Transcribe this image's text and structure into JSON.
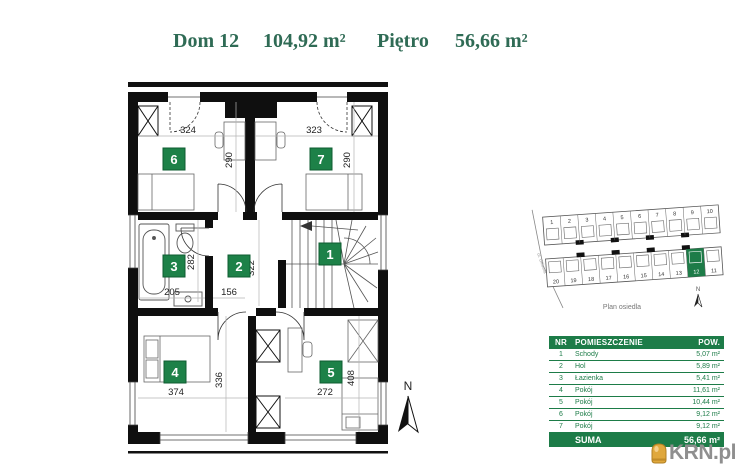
{
  "header": {
    "house_label": "Dom 12",
    "house_area": "104,92 m²",
    "floor_label": "Piętro",
    "floor_area": "56,66 m²"
  },
  "floor_plan": {
    "north_label": "N",
    "badges": {
      "b1": "1",
      "b2": "2",
      "b3": "3",
      "b4": "4",
      "b5": "5",
      "b6": "6",
      "b7": "7"
    },
    "dims": {
      "r6w": "324",
      "r6h": "290",
      "r7w": "323",
      "r7h": "290",
      "r3w": "205",
      "r3h": "282",
      "r2w": "156",
      "r2h": "322",
      "r4w": "374",
      "r4h": "336",
      "r5w": "272",
      "r5h": "408"
    }
  },
  "site_plan": {
    "caption": "Plan osiedla",
    "street_label": "ul. Główna",
    "north_label": "N",
    "top_row": [
      "1",
      "2",
      "3",
      "4",
      "5",
      "6",
      "7",
      "8",
      "9",
      "10"
    ],
    "bottom_row": [
      "20",
      "19",
      "18",
      "17",
      "16",
      "15",
      "14",
      "13",
      "12",
      "11"
    ],
    "highlighted_house": "12"
  },
  "table": {
    "headers": {
      "nr": "NR",
      "room": "POMIESZCZENIE",
      "area": "POW."
    },
    "rows": [
      {
        "nr": "1",
        "name": "Schody",
        "area": "5,07 m²"
      },
      {
        "nr": "2",
        "name": "Hol",
        "area": "5,89 m²"
      },
      {
        "nr": "3",
        "name": "Łazienka",
        "area": "5,41 m²"
      },
      {
        "nr": "4",
        "name": "Pokój",
        "area": "11,61 m²"
      },
      {
        "nr": "5",
        "name": "Pokój",
        "area": "10,44 m²"
      },
      {
        "nr": "6",
        "name": "Pokój",
        "area": "9,12 m²"
      },
      {
        "nr": "7",
        "name": "Pokój",
        "area": "9,12 m²"
      }
    ],
    "sum_label": "SUMA",
    "sum_value": "56,66 m²"
  },
  "logo": {
    "text": "KRN.pl"
  },
  "colors": {
    "green": "#1d7c48",
    "badge_green": "#1d8148",
    "title_green": "#2f6b55",
    "logo_gold": "#e0a83c",
    "logo_gray": "#8f8f8f"
  }
}
